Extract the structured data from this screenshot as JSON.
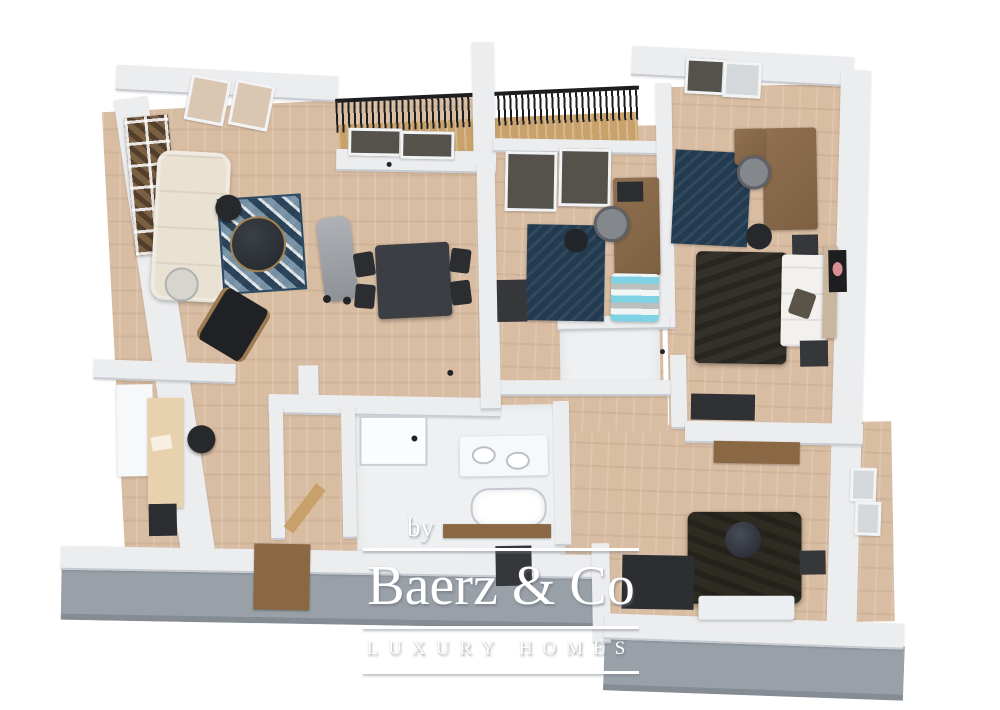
{
  "watermark": {
    "prefix": "by",
    "brand": "Baerz & Co",
    "tagline": "LUXURY HOMES"
  },
  "scene": {
    "description": "3D rendered top-down floor plan of an apartment",
    "rooms": [
      {
        "name": "living-room",
        "floor": "wood",
        "furniture": [
          "gallery-shelf",
          "sofa",
          "side-table",
          "diamond-rug",
          "coffee-table",
          "floor-lamp",
          "lounge-chair",
          "recliner"
        ]
      },
      {
        "name": "dining-area",
        "floor": "wood",
        "furniture": [
          "dining-table",
          "dining-chairs"
        ]
      },
      {
        "name": "balcony",
        "floor": "wood",
        "furniture": [
          "railing"
        ]
      },
      {
        "name": "home-office",
        "floor": "wood",
        "furniture": [
          "desk",
          "monitor",
          "office-chair",
          "navy-rug",
          "arc-lamp",
          "striped-daybed",
          "cabinet"
        ]
      },
      {
        "name": "bedroom-1",
        "floor": "wood",
        "furniture": [
          "double-bed",
          "headboard",
          "nightstands",
          "navy-rug",
          "desk",
          "chair",
          "floor-lamp",
          "dresser",
          "wall-art"
        ]
      },
      {
        "name": "bedroom-2",
        "floor": "wood",
        "furniture": [
          "double-bed",
          "round-pillow",
          "foot-bench",
          "wardrobe",
          "nightstand",
          "wall-ledge"
        ]
      },
      {
        "name": "bathroom",
        "floor": "tile",
        "furniture": [
          "shower",
          "double-sink-vanity",
          "bathtub",
          "counter"
        ]
      },
      {
        "name": "shower-room",
        "floor": "tile",
        "furniture": []
      },
      {
        "name": "hallway",
        "floor": "wood",
        "furniture": [
          "cabinet",
          "board"
        ]
      },
      {
        "name": "kitchen-nook",
        "floor": "wood",
        "furniture": [
          "tall-cabinet",
          "counter-desk",
          "stool",
          "bin"
        ]
      },
      {
        "name": "wc",
        "floor": "tile",
        "furniture": []
      }
    ],
    "colors": {
      "wall-top": "#ecedef",
      "wall-edge": "#c6cad1",
      "wall-face": "#99a0a8",
      "floor-wood": "#d9bda3",
      "floor-white": "#eef0f2",
      "balcony-wood": "#c9a26b",
      "rug-base": "#8fa5b5",
      "rug-dark": "#2e4a63",
      "rug-navy": "#233b50",
      "sofa": "#e9e1d1",
      "wood": "#8f7050",
      "wood-light": "#e8d2ae",
      "wood-mid": "#8a6844",
      "dark": "#2b2d31",
      "dark-soft": "#35373b",
      "bedding-1": "#34302a",
      "bedding-2": "#2e2b22",
      "teal": "#7fd2e4",
      "chair-grey": "#84878c",
      "white-soft": "#f7f8f9",
      "railing": "#1d1e20",
      "beige": "#d9c7b2",
      "headboard": "#c9b69e",
      "pink": "#d78f96"
    }
  }
}
